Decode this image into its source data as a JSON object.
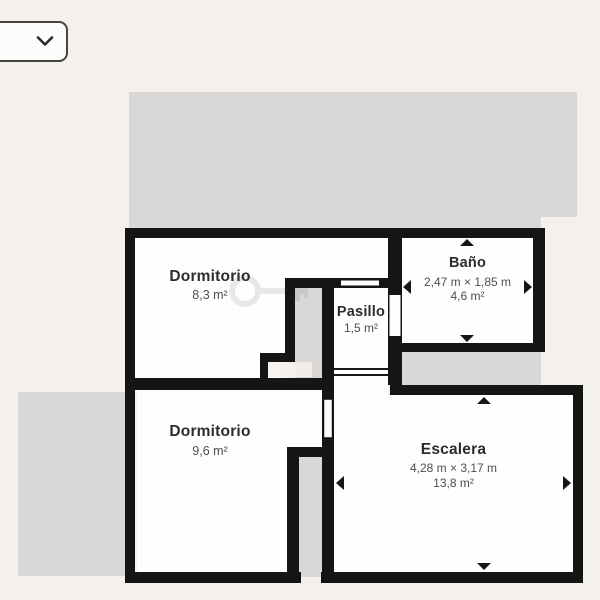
{
  "background_color": "#f4f1ec",
  "toolbar": {
    "floor_selector": {
      "chevron_icon": "chevron-down"
    }
  },
  "floorplan": {
    "colors": {
      "wall": "#151515",
      "room_fill": "#fefefe",
      "adjacent_fill": "#d9d8d6",
      "label_text": "#2c2c2c",
      "dimension_text": "#4e4e4e"
    },
    "rooms": [
      {
        "id": "dormitorio-1",
        "name": "Dormitorio",
        "area": "8,3 m²",
        "measured": false
      },
      {
        "id": "bano",
        "name": "Baño",
        "dimensions": "2,47 m × 1,85 m",
        "area": "4,6 m²",
        "measured": true
      },
      {
        "id": "pasillo",
        "name": "Pasillo",
        "area": "1,5 m²",
        "measured": false
      },
      {
        "id": "dormitorio-2",
        "name": "Dormitorio",
        "area": "9,6 m²",
        "measured": false
      },
      {
        "id": "escalera",
        "name": "Escalera",
        "dimensions": "4,28 m × 3,17 m",
        "area": "13,8 m²",
        "measured": true
      }
    ]
  }
}
